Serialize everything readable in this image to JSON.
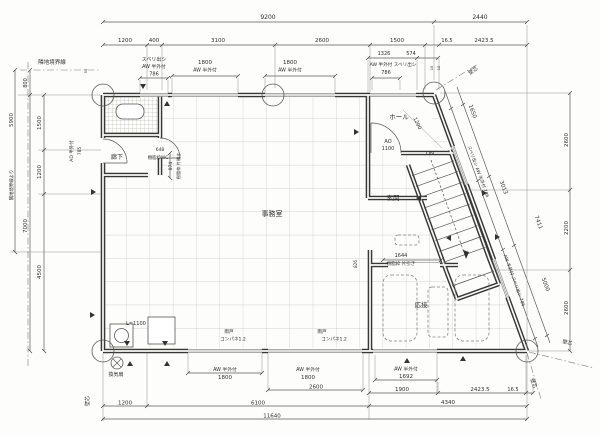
{
  "meta": {
    "drawing_type": "architectural floor plan",
    "units": "mm"
  },
  "colors": {
    "wall": "#383838",
    "window": "#8f8f8f",
    "dimension": "#5a5a5a",
    "grid": "#c6c6c2",
    "paper": "#fdfdfb"
  },
  "labels": [
    {
      "id": "room-office",
      "t": "事務室",
      "x": 272,
      "y": 216,
      "s": 7
    },
    {
      "id": "room-hall",
      "t": "ホール",
      "x": 399,
      "y": 119,
      "s": 6.5
    },
    {
      "id": "room-entrance",
      "t": "玄関",
      "x": 393,
      "y": 200,
      "s": 6.5
    },
    {
      "id": "room-reception",
      "t": "応接",
      "x": 421,
      "y": 307,
      "s": 6.5
    },
    {
      "id": "room-corridor",
      "t": "廊下",
      "x": 117,
      "y": 159,
      "s": 6
    },
    {
      "id": "stair-dn",
      "t": "DN",
      "x": 430,
      "y": 155,
      "s": 5.5
    },
    {
      "id": "dim-9200",
      "t": "9200",
      "x": 268,
      "y": 19,
      "s": 6
    },
    {
      "id": "dim-2440",
      "t": "2440",
      "x": 480,
      "y": 19,
      "s": 6
    },
    {
      "id": "dim-1200-top",
      "t": "1200",
      "x": 125,
      "y": 42,
      "s": 5.5
    },
    {
      "id": "dim-400-top",
      "t": "400",
      "x": 154,
      "y": 42,
      "s": 5.5
    },
    {
      "id": "dim-3100-top",
      "t": "3100",
      "x": 218,
      "y": 42,
      "s": 5.5
    },
    {
      "id": "dim-2600-top",
      "t": "2600",
      "x": 322,
      "y": 42,
      "s": 5.5
    },
    {
      "id": "dim-1500-top",
      "t": "1500",
      "x": 397,
      "y": 42,
      "s": 5.5
    },
    {
      "id": "dim-16-5-top",
      "t": "16.5",
      "x": 447,
      "y": 42,
      "s": 5
    },
    {
      "id": "dim-2423-5-top",
      "t": "2423.5",
      "x": 484,
      "y": 42,
      "s": 5.5
    },
    {
      "id": "dim-1326",
      "t": "1326",
      "x": 384,
      "y": 55,
      "s": 5
    },
    {
      "id": "dim-574",
      "t": "574",
      "x": 411,
      "y": 55,
      "s": 5
    },
    {
      "id": "win-sliding-tl",
      "t": "スベリ出シ",
      "x": 154,
      "y": 61,
      "s": 5
    },
    {
      "id": "win-aw-tl",
      "t": "AW 半外付",
      "x": 154,
      "y": 68,
      "s": 4.8
    },
    {
      "id": "dim-786-tl",
      "t": "786",
      "x": 154,
      "y": 75.5,
      "s": 5
    },
    {
      "id": "dim-1800-t1",
      "t": "1800",
      "x": 205,
      "y": 64,
      "s": 5.5
    },
    {
      "id": "win-aw-t1",
      "t": "AW 半外付",
      "x": 205,
      "y": 71.5,
      "s": 4.8
    },
    {
      "id": "dim-1800-t2",
      "t": "1800",
      "x": 290,
      "y": 64,
      "s": 5.5
    },
    {
      "id": "win-aw-t2",
      "t": "AW 半外付",
      "x": 290,
      "y": 71.5,
      "s": 4.8
    },
    {
      "id": "win-aw-tr",
      "t": "AW 半外付 スベリ出シ",
      "x": 393,
      "y": 66,
      "s": 4.6
    },
    {
      "id": "dim-786-tr",
      "t": "786",
      "x": 386,
      "y": 74,
      "s": 5
    },
    {
      "id": "wall-center-tr",
      "t": "壁芯",
      "x": 474,
      "y": 72,
      "r": -33,
      "s": 5
    },
    {
      "id": "note-10a",
      "t": "10",
      "x": 433,
      "y": 68,
      "r": -90,
      "s": 3.5
    },
    {
      "id": "note-10b",
      "t": "10",
      "x": 440,
      "y": 68,
      "r": -90,
      "s": 3.5
    },
    {
      "id": "note-50",
      "t": "50",
      "x": 87,
      "y": 71,
      "r": -90,
      "s": 3.5
    },
    {
      "id": "boundary-label",
      "t": "隣地境界線",
      "x": 52,
      "y": 64,
      "s": 5.5
    },
    {
      "id": "dim-5900",
      "t": "5900",
      "x": 13,
      "y": 120,
      "r": -90,
      "s": 5.5
    },
    {
      "id": "dim-5900-note",
      "t": "隣地境界線より",
      "x": 13,
      "y": 185,
      "r": -90,
      "s": 4.4
    },
    {
      "id": "dim-800-left",
      "t": "800",
      "x": 27,
      "y": 83,
      "r": -90,
      "s": 5
    },
    {
      "id": "dim-7000-left",
      "t": "7000",
      "x": 27,
      "y": 226,
      "r": -90,
      "s": 5.5
    },
    {
      "id": "dim-1500-left",
      "t": "1500",
      "x": 41,
      "y": 123,
      "r": -90,
      "s": 5.5
    },
    {
      "id": "dim-1200-left",
      "t": "1200",
      "x": 41,
      "y": 172,
      "r": -90,
      "s": 5.5
    },
    {
      "id": "dim-4500-left",
      "t": "4500",
      "x": 41,
      "y": 272,
      "r": -90,
      "s": 5.5
    },
    {
      "id": "door-ad-label",
      "t": "AD 半外付",
      "x": 73,
      "y": 151,
      "r": -90,
      "s": 4.5
    },
    {
      "id": "dim-785",
      "t": "785",
      "x": 81,
      "y": 151,
      "r": -90,
      "s": 4.5
    },
    {
      "id": "wall-center-bl",
      "t": "壁芯",
      "x": 89,
      "y": 401,
      "r": -90,
      "s": 5
    },
    {
      "id": "dim-2600-r1",
      "t": "2600",
      "x": 568,
      "y": 140,
      "r": -90,
      "s": 5.5
    },
    {
      "id": "dim-2200-r",
      "t": "2200",
      "x": 568,
      "y": 228,
      "r": -90,
      "s": 5.5
    },
    {
      "id": "dim-2600-r2",
      "t": "2600",
      "x": 568,
      "y": 308,
      "r": -90,
      "s": 5.5
    },
    {
      "id": "dim-1650",
      "t": "1650",
      "x": 471,
      "y": 112,
      "r": 70,
      "s": 5.5
    },
    {
      "id": "dim-3013",
      "t": "3013",
      "x": 502,
      "y": 188,
      "r": 70,
      "s": 5.5
    },
    {
      "id": "dim-7411",
      "t": "7411",
      "x": 537,
      "y": 223,
      "r": 70,
      "s": 5.5
    },
    {
      "id": "dim-5000",
      "t": "5000",
      "x": 544,
      "y": 285,
      "r": 70,
      "s": 5.5
    },
    {
      "id": "win-diag-upper",
      "t": "スベリ出シ AW 半外付 786",
      "x": 477,
      "y": 172,
      "r": 70,
      "s": 4.4
    },
    {
      "id": "win-diag-lower",
      "t": "AW 半外付 スベリ出シ 786",
      "x": 513,
      "y": 281,
      "r": 70,
      "s": 4.4
    },
    {
      "id": "wall-center-br1",
      "t": "壁芯",
      "x": 567,
      "y": 344,
      "r": 15,
      "s": 5
    },
    {
      "id": "wall-center-br2",
      "t": "壁芯",
      "x": 532,
      "y": 384,
      "r": 70,
      "s": 5
    },
    {
      "id": "win-aw-b1",
      "t": "AW 半外付",
      "x": 225,
      "y": 371,
      "s": 4.8
    },
    {
      "id": "dim-1800-b1",
      "t": "1800",
      "x": 225,
      "y": 379,
      "s": 5.5
    },
    {
      "id": "win-aw-b2",
      "t": "AW 半外付",
      "x": 308,
      "y": 371,
      "s": 4.8
    },
    {
      "id": "dim-1800-b2",
      "t": "1800",
      "x": 308,
      "y": 379,
      "s": 5.5
    },
    {
      "id": "dim-2600-b",
      "t": "2600",
      "x": 316,
      "y": 388.5,
      "s": 5.5
    },
    {
      "id": "win-aw-b3",
      "t": "AW 半外付",
      "x": 406,
      "y": 370.5,
      "s": 4.8
    },
    {
      "id": "dim-1692",
      "t": "1692",
      "x": 406,
      "y": 378,
      "s": 5.5
    },
    {
      "id": "dim-1900-b",
      "t": "1900",
      "x": 402,
      "y": 391,
      "s": 5.5
    },
    {
      "id": "dim-2423-5-b",
      "t": "2423.5",
      "x": 480,
      "y": 391,
      "s": 5.5
    },
    {
      "id": "dim-16-5-b",
      "t": "16.5",
      "x": 513,
      "y": 391,
      "s": 5
    },
    {
      "id": "dim-1200-b",
      "t": "1200",
      "x": 125,
      "y": 404.5,
      "s": 5.5
    },
    {
      "id": "dim-6100-b",
      "t": "6100",
      "x": 258,
      "y": 404.5,
      "s": 5.5
    },
    {
      "id": "dim-4340-b",
      "t": "4340",
      "x": 448,
      "y": 404,
      "s": 5.5
    },
    {
      "id": "dim-11640",
      "t": "11640",
      "x": 272,
      "y": 417.5,
      "s": 5.5
    },
    {
      "id": "vent-fan-label",
      "t": "換気扇",
      "x": 116,
      "y": 376,
      "s": 5
    },
    {
      "id": "counter-length",
      "t": "L=1100",
      "x": 136,
      "y": 325,
      "s": 5
    },
    {
      "id": "door-ao",
      "t": "AO",
      "x": 388,
      "y": 143,
      "s": 5
    },
    {
      "id": "dim-1100",
      "t": "1100",
      "x": 388,
      "y": 150,
      "s": 5
    },
    {
      "id": "dim-1200-diag",
      "t": "1200",
      "x": 416,
      "y": 124,
      "r": 65,
      "s": 5
    },
    {
      "id": "dim-648",
      "t": "648",
      "x": 160,
      "y": 151,
      "s": 4.5
    },
    {
      "id": "door-wc-label",
      "t": "樹脂枠WC",
      "x": 158,
      "y": 159,
      "s": 4.4
    },
    {
      "id": "dim-874",
      "t": "874",
      "x": 172,
      "y": 166,
      "r": -90,
      "s": 4.4
    },
    {
      "id": "door-hinged-label",
      "t": "樹脂枠 片開き",
      "x": 180,
      "y": 166,
      "r": -90,
      "s": 4.2
    },
    {
      "id": "dim-1644",
      "t": "1644",
      "x": 401,
      "y": 257,
      "s": 5
    },
    {
      "id": "door-sliding-label",
      "t": "樹脂枠 片引き",
      "x": 401,
      "y": 265,
      "s": 4.5
    },
    {
      "id": "shutter-b1",
      "t": "雨戸",
      "x": 229,
      "y": 333,
      "s": 4.6
    },
    {
      "id": "shutter-b1-panel",
      "t": "コンパネ1.2",
      "x": 233,
      "y": 340.5,
      "s": 4.6
    },
    {
      "id": "shutter-b2",
      "t": "雨戸",
      "x": 322,
      "y": 333,
      "s": 4.6
    },
    {
      "id": "shutter-b2-panel",
      "t": "コンパネ1.2",
      "x": 334,
      "y": 340.5,
      "s": 4.6
    },
    {
      "id": "dim-826",
      "t": "826",
      "x": 357,
      "y": 264,
      "r": -90,
      "s": 4.2
    }
  ]
}
